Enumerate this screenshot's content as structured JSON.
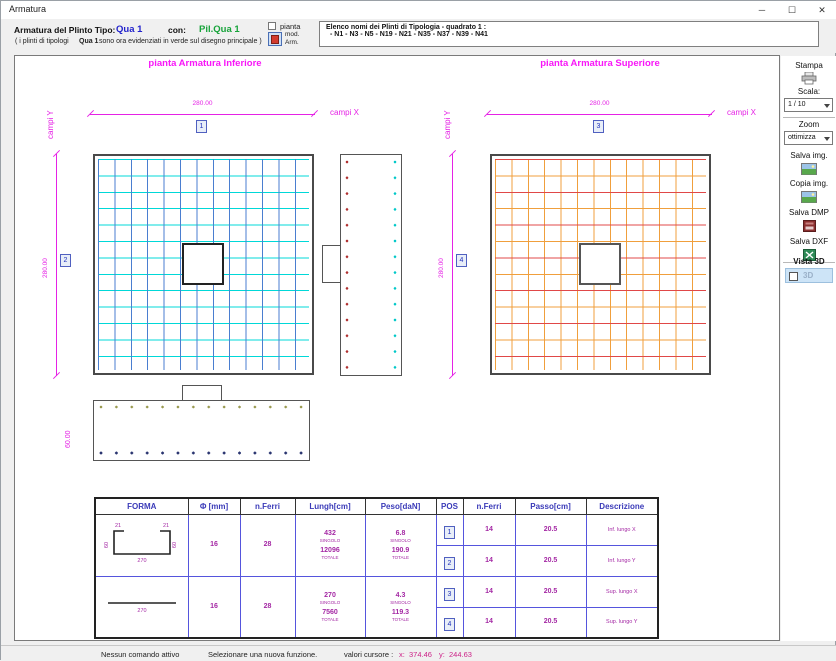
{
  "window": {
    "title": "Armatura",
    "minimize": "─",
    "maximize": "☐",
    "close": "✕"
  },
  "header": {
    "tipo_label": "Armatura  del  Plinto  Tipo:",
    "tipo_value": "Qua 1",
    "con_label": "con:",
    "pil_value": "Pil.Qua 1",
    "note_prefix": "( i plinti di tipologi",
    "note_bold": "Qua 1",
    "note_suffix": "sono ora evidenziati in verde sul disegno principale )",
    "pianta_label": "pianta",
    "mod_label": "mod.",
    "arm_label": "Arm.",
    "elenco_title": "Elenco nomi dei Plinti di Tipologia  - quadrato 1 :",
    "elenco_list": "- N1 - N3 - N5 - N19 - N21 - N35 - N37 - N39 - N41"
  },
  "drawings": {
    "inferiore": {
      "title": "pianta Armatura Inferiore",
      "campi_y": "campi Y",
      "campi_x": "campi X",
      "dim_x": "280.00",
      "dim_y": "280.00",
      "pos_top": "1",
      "pos_side": "2"
    },
    "superiore": {
      "title": "pianta Armatura Superiore",
      "campi_y": "campi Y",
      "campi_x": "campi X",
      "dim_x": "280.00",
      "dim_y": "280.00",
      "pos_top": "3",
      "pos_side": "4"
    },
    "section_height": "60.00"
  },
  "sidebar": {
    "stampa": "Stampa",
    "scala_label": "Scala:",
    "scala_value": "1 / 10",
    "zoom_label": "Zoom",
    "zoom_value": "ottimizza",
    "salva_img": "Salva img.",
    "copia_img": "Copia img.",
    "salva_dmp": "Salva DMP",
    "salva_dxf": "Salva DXF",
    "vista3d_label": "Vista 3D",
    "vista3d_check": "3D"
  },
  "table": {
    "headers": [
      "FORMA",
      "Φ [mm]",
      "n.Ferri",
      "Lungh[cm]",
      "Peso[daN]",
      "POS",
      "n.Ferri",
      "Passo[cm]",
      "Descrizione"
    ],
    "singolo": "SINGOLO",
    "totale": "TOTALE",
    "groups": [
      {
        "shape": {
          "hook_left": "21",
          "hook_right": "21",
          "leg_left": "60",
          "leg_right": "60",
          "base": "270"
        },
        "diam": "16",
        "n_ferri": "28",
        "lungh_singolo": "432",
        "lungh_totale": "12096",
        "peso_singolo": "6.8",
        "peso_totale": "190.9",
        "rows": [
          {
            "pos": "1",
            "n_ferri": "14",
            "passo": "20.5",
            "descr": "Inf. lungo X"
          },
          {
            "pos": "2",
            "n_ferri": "14",
            "passo": "20.5",
            "descr": "Inf. lungo Y"
          }
        ]
      },
      {
        "shape": {
          "base": "270"
        },
        "diam": "16",
        "n_ferri": "28",
        "lungh_singolo": "270",
        "lungh_totale": "7560",
        "peso_singolo": "4.3",
        "peso_totale": "119.3",
        "rows": [
          {
            "pos": "3",
            "n_ferri": "14",
            "passo": "20.5",
            "descr": "Sup. lungo X"
          },
          {
            "pos": "4",
            "n_ferri": "14",
            "passo": "20.5",
            "descr": "Sup. lungo Y"
          }
        ]
      }
    ]
  },
  "statusbar": {
    "left": "Nessun comando attivo",
    "middle": "Selezionare una nuova funzione.",
    "cursor_label": "valori cursore :",
    "x_label": "x:",
    "x_value": "374.46",
    "y_label": "y:",
    "y_value": "244.63"
  },
  "colors": {
    "magenta": "#e522e5",
    "cyan": "#00d8d8",
    "grid_blue": "#4a7ed0",
    "orange": "#f09f3c",
    "red": "#e04848",
    "tipo_blue": "#2222cc",
    "pil_green": "#17a33a",
    "value_purple": "#a428a4",
    "header_blue": "#3a3ab8"
  }
}
